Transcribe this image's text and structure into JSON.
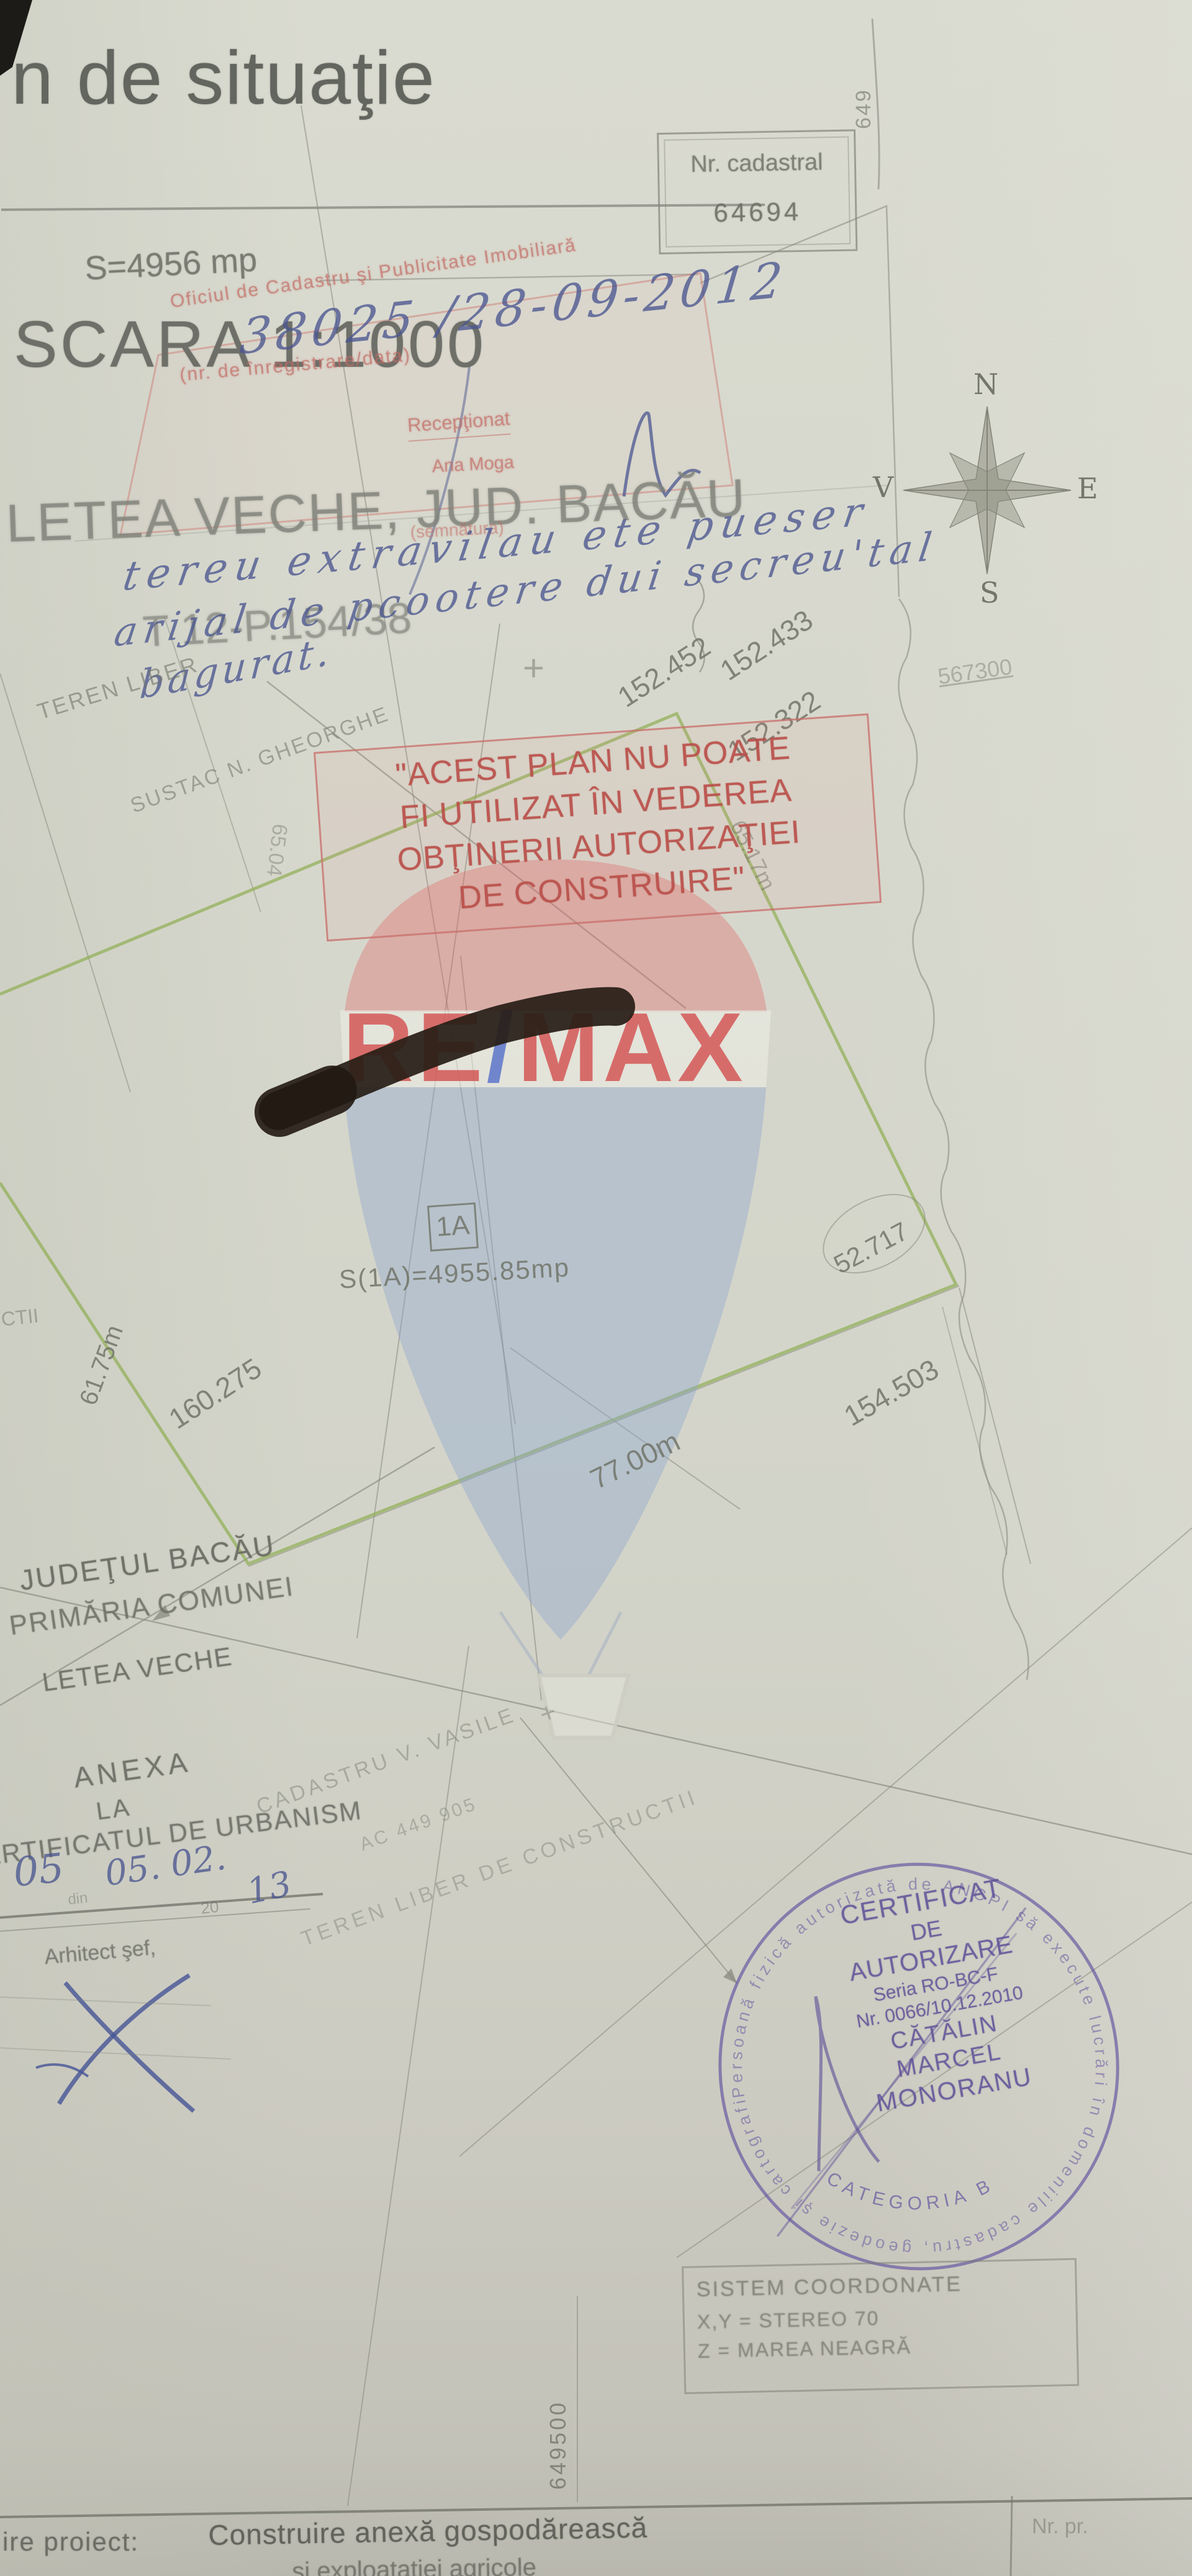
{
  "document": {
    "title_fragment": "n de situaţie",
    "scale": "SCARA 1:1000",
    "location": "LETEA VECHE, JUD. BACĂU",
    "parcel_ref": "T 12-P.154/38",
    "area": "S=4956 mp",
    "grid_label_top": "649",
    "grid_label_left": "649500"
  },
  "cadastral_box": {
    "label": "Nr. cadastral",
    "number": "64694"
  },
  "ocpi_stamp": {
    "office": "Oficiul de Cadastru şi Publicitate Imobiliară",
    "registration": "38025 /28-09-2012",
    "registration_caption": "(nr. de înregistrare/data)",
    "received_label": "Recepţionat",
    "received_by": "Ana Moga",
    "signature_caption": "(semnătura)"
  },
  "handwriting_note": {
    "line1": "tereu extravilau ete pueser",
    "line2": "arijal de pcootere dui secreu'tal",
    "line3": "bagurat."
  },
  "restriction_stamp": {
    "line1": "\"ACEST PLAN NU POATE",
    "line2": "FI UTILIZAT ÎN VEDEREA",
    "line3": "OBŢINERII AUTORIZAŢIEI",
    "line4": "DE CONSTRUIRE\""
  },
  "compass": {
    "north": "N",
    "east": "E",
    "south": "S",
    "west": "V"
  },
  "plan": {
    "neighbor_area": "TEREN LIBER",
    "neighbor_owner": "SUSTAC N. GHEORGHE",
    "elevation_1": "152.452",
    "elevation_2": "152.433",
    "elevation_3": "152.322",
    "grid_value": "567300",
    "dim_right": "65.17m",
    "dim_inner": "65.04",
    "parcel_id": "1A",
    "parcel_area": "S(1A)=4955.85mp",
    "elevation_4": "52.717",
    "elevation_5": "154.503",
    "dim_bottom": "77.00m",
    "dim_left": "61.75m",
    "elevation_6": "160.275",
    "edge_label": "CTII",
    "plus": "+"
  },
  "admin_block": {
    "county": "JUDEŢUL BACĂU",
    "commune": "PRIMĂRIA COMUNEI",
    "village": "LETEA VECHE",
    "annex": "ANEXA",
    "annex_to": "LA",
    "certificate": "CERTIFICATUL DE URBANISM",
    "number_hw": "05",
    "din": "din",
    "date_hw": "05. 02.",
    "year_print": "20",
    "year_hw": "13",
    "architect": "Arhitect şef,"
  },
  "survey_notes": {
    "surveyor": "CADASTRU V. VASILE",
    "act": "AC 449 905",
    "note": "TEREN LIBER DE CONSTRUCTII"
  },
  "round_stamp": {
    "rim": "Persoană fizică autorizată de ANCPI să execute lucrări în domeniile cadastru, geodezie şi cartografie ●",
    "line1": "CERTIFICAT",
    "line2": "DE",
    "line3": "AUTORIZARE",
    "line4": "Seria RO-BC-F",
    "line5": "Nr. 0066/10.12.2010",
    "line6": "CĂTĂLIN",
    "line7": "MARCEL",
    "line8": "MONORANU",
    "category": "CATEGORIA B"
  },
  "coord_box": {
    "line1": "SISTEM COORDONATE",
    "line2": "X,Y = STEREO 70",
    "line3": "Z = MAREA NEAGRĂ"
  },
  "footer": {
    "project_label": "ire  proiect:",
    "project_name": "Construire anexă gospodărească",
    "project_name_2": "şi exploataţiei agricole",
    "nr_label": "Nr. pr."
  },
  "watermark": {
    "re": "RE",
    "slash": "/",
    "max": "MAX"
  },
  "colors": {
    "paper": "#d6d7cc",
    "pencil": "#717468",
    "ink_blue": "#4a5690",
    "stamp_red": "#b9544e",
    "stamp_pink": "#c97f79",
    "stamp_purple": "#605298",
    "parcel_green": "#8fae52",
    "watermark_red": "#d23f3f",
    "watermark_blue": "#4562c8"
  }
}
